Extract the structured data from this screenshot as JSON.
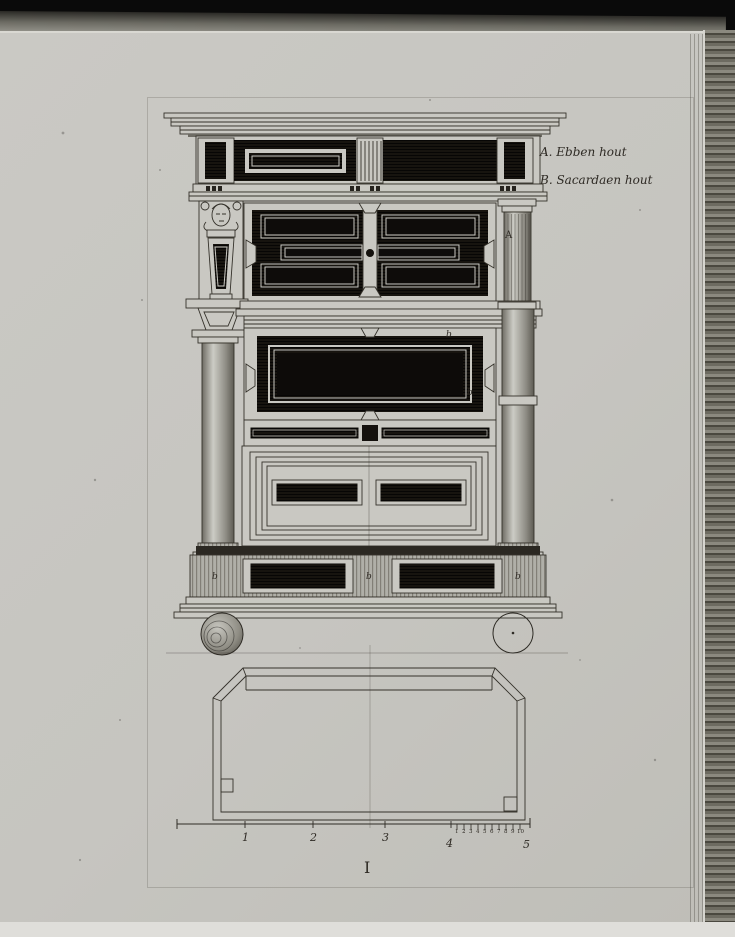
{
  "plate": {
    "numeral": "I",
    "legend": {
      "entry_a": "A. Ebben hout",
      "entry_b": "B. Sacardaen hout"
    },
    "part_labels": {
      "column": "A",
      "middle_panel_top": "b",
      "middle_panel_side": "b",
      "plinth_left": "b",
      "plinth_center": "b",
      "plinth_right": "b"
    },
    "scale_bar": {
      "major_ticks": [
        "1",
        "2",
        "3",
        "4",
        "5"
      ],
      "minor_ticks": [
        "1",
        "2",
        "3",
        "4",
        "5",
        "6",
        "7",
        "8",
        "9",
        "10"
      ]
    },
    "colors": {
      "paper": "#c7c6c1",
      "ink": "#2e2b25",
      "ebony_panel": "#14110d",
      "photo_background": "#0a0a0a"
    }
  }
}
